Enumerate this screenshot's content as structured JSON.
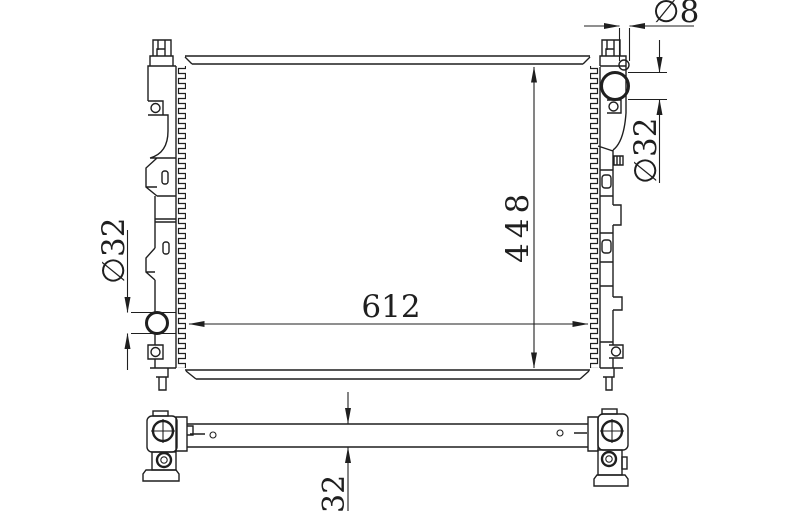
{
  "colors": {
    "background": "#ffffff",
    "line": "#1f1f1f"
  },
  "views": {
    "front": {
      "dimensions": {
        "width_label": "612",
        "height_label": "448",
        "inlet_diameter_label": "∅32",
        "outlet_diameter_label": "∅32",
        "pin_diameter_label": "∅8"
      }
    },
    "bottom": {
      "dimensions": {
        "thickness_label": "32"
      }
    }
  }
}
